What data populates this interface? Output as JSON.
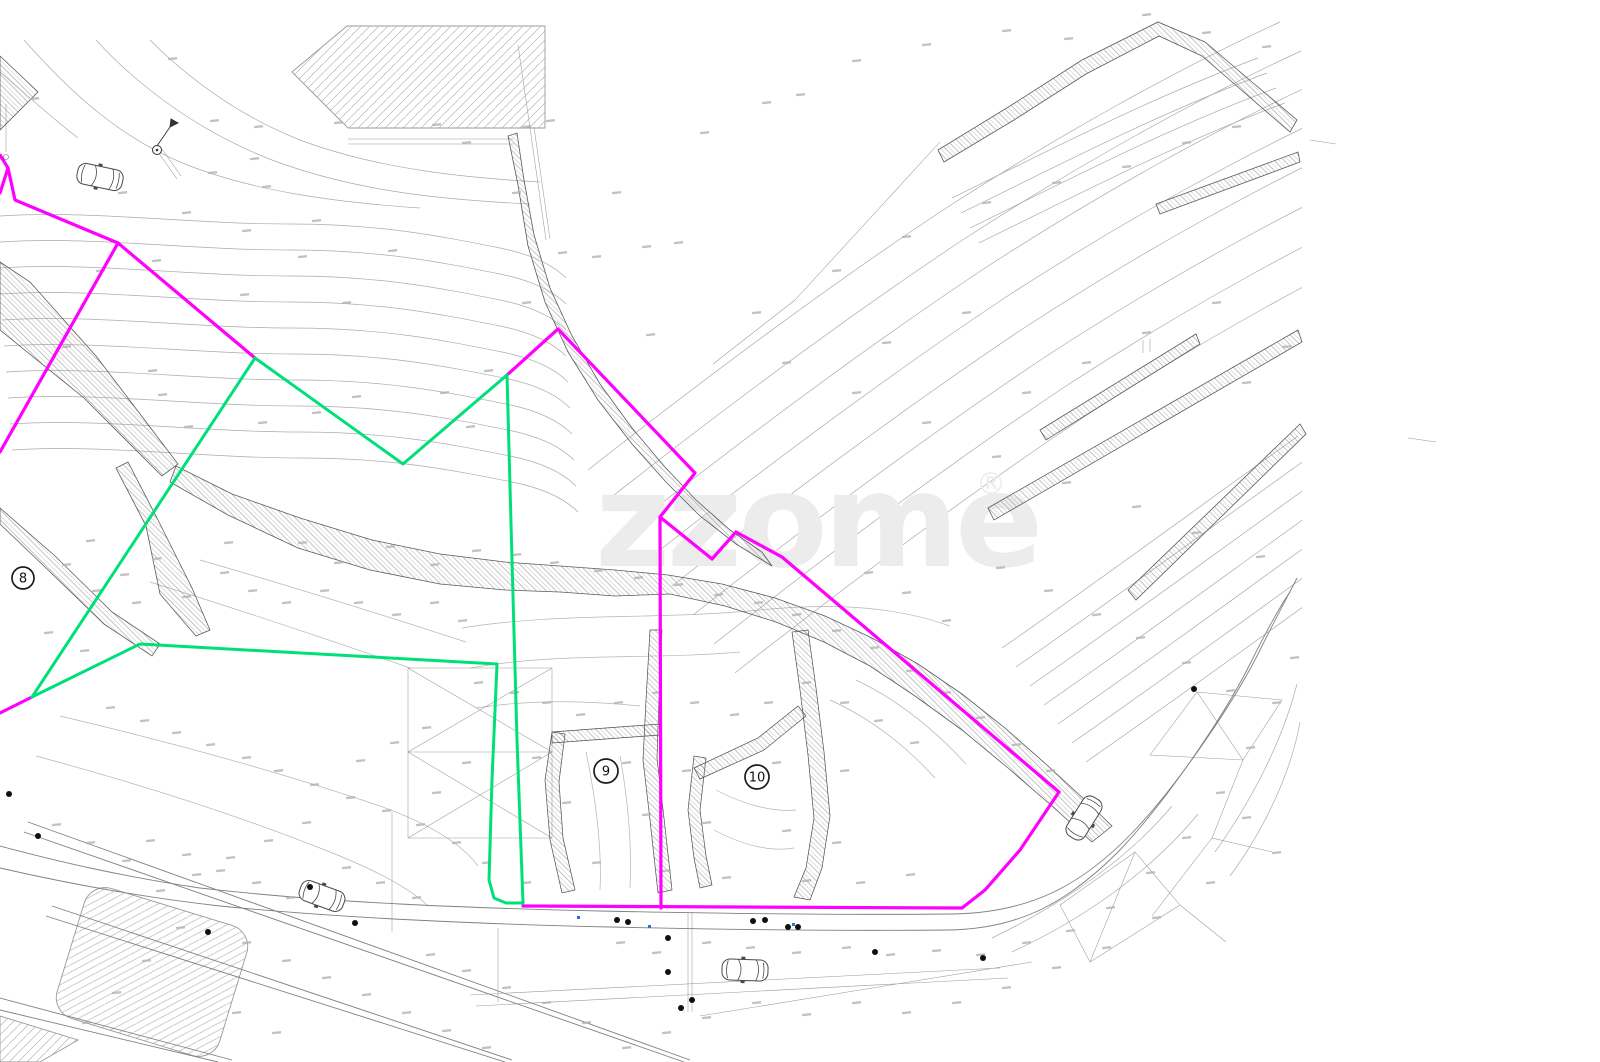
{
  "canvas": {
    "width": 1600,
    "height": 1062,
    "background": "#ffffff"
  },
  "watermark": {
    "text": "zzome",
    "registered_mark": "®",
    "color": "#ececec"
  },
  "plot_markers": [
    {
      "label": "8",
      "x": 23,
      "y": 578,
      "r": 11
    },
    {
      "label": "9",
      "x": 606,
      "y": 771,
      "r": 12
    },
    {
      "label": "10",
      "x": 757,
      "y": 777,
      "r": 12
    }
  ],
  "boundaries": {
    "parcel_magenta": {
      "color": "#ff00ff",
      "width": 3.2,
      "polylines": [
        [
          [
            0,
            155
          ],
          [
            8,
            168
          ],
          [
            15,
            200
          ],
          [
            118,
            243
          ],
          [
            255,
            358
          ]
        ],
        [
          [
            8,
            168
          ],
          [
            0,
            193
          ]
        ],
        [
          [
            118,
            243
          ],
          [
            0,
            452
          ]
        ],
        [
          [
            0,
            713
          ],
          [
            32,
            697
          ]
        ],
        [
          [
            507,
            375
          ],
          [
            558,
            329
          ],
          [
            695,
            473
          ],
          [
            660,
            517
          ],
          [
            661,
            908
          ]
        ],
        [
          [
            660,
            517
          ],
          [
            712,
            559
          ],
          [
            736,
            532
          ],
          [
            782,
            557
          ],
          [
            1059,
            792
          ]
        ],
        [
          [
            1059,
            792
          ],
          [
            1020,
            850
          ],
          [
            985,
            890
          ],
          [
            962,
            908
          ],
          [
            523,
            906
          ]
        ]
      ]
    },
    "parcel_green": {
      "color": "#00e07a",
      "width": 3,
      "polylines": [
        [
          [
            32,
            697
          ],
          [
            255,
            358
          ]
        ],
        [
          [
            255,
            358
          ],
          [
            403,
            464
          ],
          [
            507,
            375
          ]
        ],
        [
          [
            507,
            375
          ],
          [
            512,
            560
          ],
          [
            517,
            740
          ],
          [
            523,
            903
          ]
        ],
        [
          [
            32,
            697
          ],
          [
            140,
            644
          ],
          [
            497,
            664
          ],
          [
            492,
            780
          ],
          [
            489,
            880
          ],
          [
            494,
            898
          ],
          [
            506,
            903
          ],
          [
            523,
            903
          ]
        ]
      ]
    }
  },
  "symbols": {
    "cars": [
      {
        "x": 100,
        "y": 177,
        "angle": 12
      },
      {
        "x": 322,
        "y": 896,
        "angle": 20
      },
      {
        "x": 745,
        "y": 970,
        "angle": 2
      },
      {
        "x": 1084,
        "y": 818,
        "angle": -58
      }
    ],
    "tree_dots": [
      [
        9,
        794
      ],
      [
        38,
        836
      ],
      [
        355,
        923
      ],
      [
        617,
        920
      ],
      [
        628,
        922
      ],
      [
        668,
        938
      ],
      [
        753,
        921
      ],
      [
        765,
        920
      ],
      [
        788,
        927
      ],
      [
        798,
        927
      ],
      [
        668,
        972
      ],
      [
        692,
        1000
      ],
      [
        681,
        1008
      ],
      [
        875,
        952
      ],
      [
        983,
        958
      ],
      [
        1194,
        689
      ],
      [
        208,
        932
      ],
      [
        310,
        887
      ]
    ],
    "blue_marks": [
      [
        577,
        916
      ],
      [
        648,
        925
      ],
      [
        792,
        923
      ]
    ],
    "survey_flag": {
      "x": 157,
      "y": 150
    }
  },
  "spot_marks": [
    [
      168,
      58
    ],
    [
      210,
      120
    ],
    [
      250,
      158
    ],
    [
      208,
      172
    ],
    [
      262,
      186
    ],
    [
      118,
      192
    ],
    [
      30,
      98
    ],
    [
      182,
      212
    ],
    [
      242,
      230
    ],
    [
      312,
      220
    ],
    [
      388,
      250
    ],
    [
      298,
      256
    ],
    [
      152,
      260
    ],
    [
      96,
      270
    ],
    [
      240,
      294
    ],
    [
      342,
      302
    ],
    [
      62,
      346
    ],
    [
      148,
      370
    ],
    [
      158,
      394
    ],
    [
      184,
      426
    ],
    [
      258,
      422
    ],
    [
      312,
      412
    ],
    [
      352,
      396
    ],
    [
      440,
      392
    ],
    [
      466,
      426
    ],
    [
      484,
      370
    ],
    [
      522,
      302
    ],
    [
      558,
      252
    ],
    [
      592,
      256
    ],
    [
      642,
      246
    ],
    [
      674,
      242
    ],
    [
      612,
      192
    ],
    [
      512,
      192
    ],
    [
      462,
      142
    ],
    [
      432,
      124
    ],
    [
      546,
      120
    ],
    [
      254,
      126
    ],
    [
      334,
      122
    ],
    [
      522,
      126
    ],
    [
      700,
      132
    ],
    [
      762,
      102
    ],
    [
      796,
      94
    ],
    [
      852,
      60
    ],
    [
      922,
      44
    ],
    [
      1002,
      30
    ],
    [
      1064,
      38
    ],
    [
      1142,
      14
    ],
    [
      1202,
      32
    ],
    [
      1262,
      46
    ],
    [
      1232,
      126
    ],
    [
      1182,
      142
    ],
    [
      1122,
      166
    ],
    [
      1052,
      182
    ],
    [
      982,
      202
    ],
    [
      902,
      236
    ],
    [
      832,
      270
    ],
    [
      752,
      312
    ],
    [
      646,
      334
    ],
    [
      782,
      362
    ],
    [
      852,
      392
    ],
    [
      922,
      422
    ],
    [
      992,
      456
    ],
    [
      1062,
      482
    ],
    [
      1132,
      506
    ],
    [
      1192,
      532
    ],
    [
      1256,
      556
    ],
    [
      1242,
      382
    ],
    [
      1282,
      346
    ],
    [
      1212,
      302
    ],
    [
      1142,
      332
    ],
    [
      1082,
      362
    ],
    [
      1022,
      392
    ],
    [
      962,
      312
    ],
    [
      882,
      342
    ],
    [
      86,
      540
    ],
    [
      62,
      564
    ],
    [
      120,
      574
    ],
    [
      152,
      558
    ],
    [
      92,
      590
    ],
    [
      132,
      602
    ],
    [
      44,
      632
    ],
    [
      80,
      650
    ],
    [
      182,
      596
    ],
    [
      220,
      572
    ],
    [
      248,
      590
    ],
    [
      282,
      602
    ],
    [
      320,
      590
    ],
    [
      354,
      602
    ],
    [
      392,
      614
    ],
    [
      430,
      602
    ],
    [
      458,
      620
    ],
    [
      334,
      562
    ],
    [
      298,
      542
    ],
    [
      224,
      542
    ],
    [
      386,
      546
    ],
    [
      430,
      564
    ],
    [
      472,
      550
    ],
    [
      512,
      554
    ],
    [
      550,
      562
    ],
    [
      594,
      570
    ],
    [
      634,
      577
    ],
    [
      674,
      584
    ],
    [
      714,
      594
    ],
    [
      754,
      602
    ],
    [
      792,
      614
    ],
    [
      832,
      630
    ],
    [
      870,
      647
    ],
    [
      906,
      670
    ],
    [
      942,
      692
    ],
    [
      976,
      717
    ],
    [
      1012,
      744
    ],
    [
      1046,
      770
    ],
    [
      942,
      620
    ],
    [
      902,
      592
    ],
    [
      864,
      572
    ],
    [
      474,
      682
    ],
    [
      510,
      692
    ],
    [
      542,
      702
    ],
    [
      576,
      714
    ],
    [
      614,
      702
    ],
    [
      652,
      692
    ],
    [
      690,
      702
    ],
    [
      730,
      714
    ],
    [
      764,
      702
    ],
    [
      802,
      682
    ],
    [
      840,
      702
    ],
    [
      874,
      720
    ],
    [
      910,
      742
    ],
    [
      532,
      757
    ],
    [
      622,
      762
    ],
    [
      682,
      770
    ],
    [
      772,
      762
    ],
    [
      840,
      770
    ],
    [
      562,
      802
    ],
    [
      642,
      814
    ],
    [
      702,
      822
    ],
    [
      782,
      830
    ],
    [
      832,
      842
    ],
    [
      592,
      862
    ],
    [
      662,
      870
    ],
    [
      722,
      877
    ],
    [
      802,
      880
    ],
    [
      856,
      882
    ],
    [
      906,
      874
    ],
    [
      522,
      882
    ],
    [
      482,
      862
    ],
    [
      452,
      842
    ],
    [
      416,
      824
    ],
    [
      382,
      810
    ],
    [
      346,
      797
    ],
    [
      310,
      784
    ],
    [
      274,
      770
    ],
    [
      242,
      757
    ],
    [
      206,
      744
    ],
    [
      172,
      732
    ],
    [
      140,
      720
    ],
    [
      106,
      707
    ],
    [
      422,
      727
    ],
    [
      390,
      742
    ],
    [
      356,
      760
    ],
    [
      462,
      762
    ],
    [
      432,
      792
    ],
    [
      302,
      822
    ],
    [
      264,
      840
    ],
    [
      226,
      857
    ],
    [
      192,
      874
    ],
    [
      156,
      890
    ],
    [
      122,
      860
    ],
    [
      86,
      842
    ],
    [
      52,
      824
    ],
    [
      342,
      867
    ],
    [
      376,
      882
    ],
    [
      412,
      897
    ],
    [
      616,
      942
    ],
    [
      652,
      952
    ],
    [
      702,
      942
    ],
    [
      746,
      947
    ],
    [
      792,
      952
    ],
    [
      842,
      947
    ],
    [
      886,
      954
    ],
    [
      932,
      950
    ],
    [
      976,
      954
    ],
    [
      1022,
      942
    ],
    [
      1066,
      930
    ],
    [
      1106,
      907
    ],
    [
      1146,
      872
    ],
    [
      1182,
      837
    ],
    [
      1216,
      792
    ],
    [
      1246,
      747
    ],
    [
      1272,
      702
    ],
    [
      1290,
      657
    ],
    [
      1136,
      637
    ],
    [
      1182,
      662
    ],
    [
      1226,
      690
    ],
    [
      1092,
      614
    ],
    [
      1044,
      590
    ],
    [
      996,
      567
    ],
    [
      1242,
      817
    ],
    [
      1272,
      852
    ],
    [
      1206,
      882
    ],
    [
      1152,
      917
    ],
    [
      1102,
      947
    ],
    [
      1052,
      967
    ],
    [
      1002,
      987
    ],
    [
      952,
      1002
    ],
    [
      902,
      1012
    ],
    [
      852,
      1002
    ],
    [
      802,
      1014
    ],
    [
      752,
      1002
    ],
    [
      702,
      1017
    ],
    [
      662,
      1032
    ],
    [
      622,
      1047
    ],
    [
      582,
      1022
    ],
    [
      542,
      1002
    ],
    [
      502,
      987
    ],
    [
      462,
      970
    ],
    [
      426,
      954
    ],
    [
      286,
      897
    ],
    [
      252,
      882
    ],
    [
      216,
      870
    ],
    [
      182,
      854
    ],
    [
      146,
      840
    ],
    [
      242,
      942
    ],
    [
      282,
      960
    ],
    [
      322,
      977
    ],
    [
      362,
      994
    ],
    [
      402,
      1012
    ],
    [
      442,
      1030
    ],
    [
      482,
      1047
    ],
    [
      176,
      927
    ],
    [
      142,
      960
    ],
    [
      112,
      992
    ],
    [
      82,
      1022
    ],
    [
      272,
      1032
    ],
    [
      232,
      1012
    ]
  ]
}
